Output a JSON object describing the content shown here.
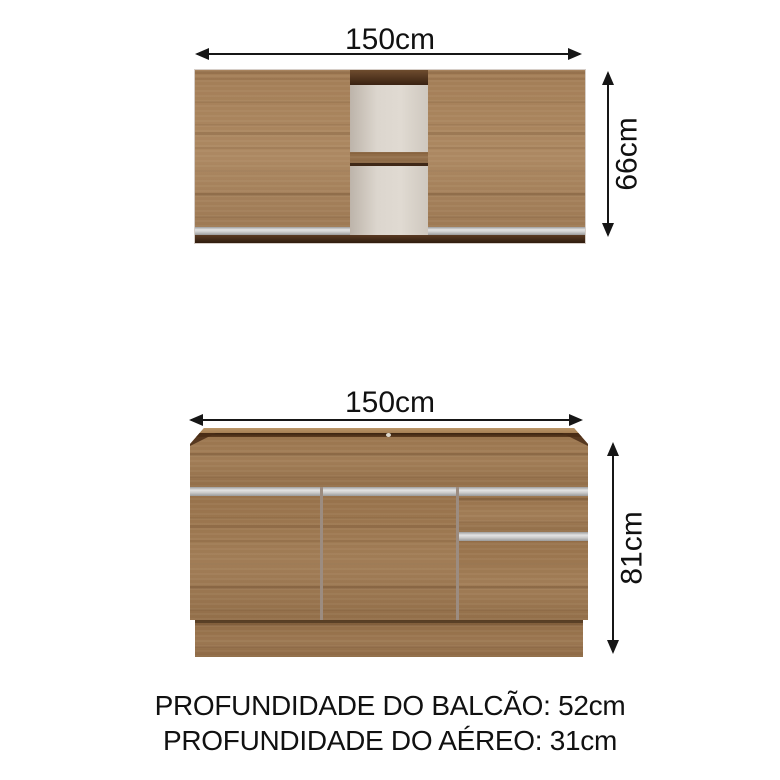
{
  "dimensions": {
    "upper_width": "150cm",
    "upper_height": "66cm",
    "lower_width": "150cm",
    "lower_height": "81cm"
  },
  "captions": {
    "line1": "PROFUNDIDADE DO BALCÃO: 52cm",
    "line2": "PROFUNDIDADE DO AÉREO: 31cm"
  },
  "colors": {
    "wood": "#9c7750",
    "wood_light": "#a8835c",
    "edge_dark": "#4e3018",
    "rail_light": "#b28a5c",
    "interior": "#d8d1c8",
    "silver": "#c9c9c9",
    "arrow": "#161616",
    "text": "#111111",
    "bg": "#ffffff"
  }
}
